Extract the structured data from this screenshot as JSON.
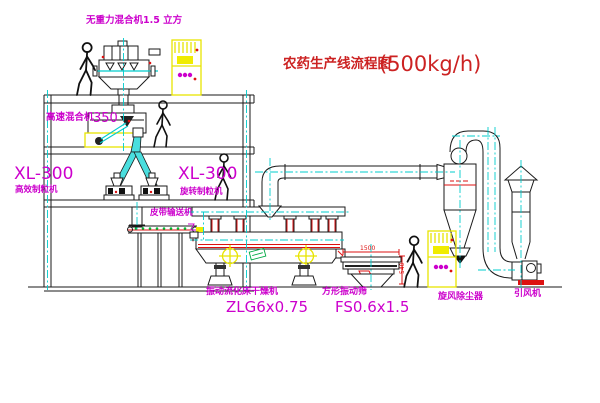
{
  "title": {
    "name": "农药生产线流程图",
    "capacity": "(500kg/h)"
  },
  "labels": {
    "gravity_mixer": "无重力混合机1.5 立方",
    "high_speed_mixer_name": "高速混合机",
    "high_speed_mixer_model": "350",
    "granulator_left_model": "XL-300",
    "granulator_left_name": "高效制粒机",
    "granulator_right_model": "XL-300",
    "granulator_right_name": "旋转制粒机",
    "belt_conveyor": "皮带输送机",
    "dryer_name": "振动流化床干燥机",
    "dryer_model": "ZLG6x0.75",
    "screen_name": "方形振动筛",
    "screen_model": "FS0.6x1.5",
    "cyclone": "旋风除尘器",
    "fan": "引风机"
  },
  "dimensions": {
    "screen_width": "1500",
    "screen_height": "540"
  },
  "colors": {
    "line": "#1a1a1a",
    "centerline": "#00cccc",
    "label_magenta": "#cc00cc",
    "title_red": "#cc2222",
    "accent_red": "#dd1111",
    "cabinet_yellow": "#f0ec00",
    "chute_cyan": "#4adede",
    "plate_green": "#00aa44"
  }
}
